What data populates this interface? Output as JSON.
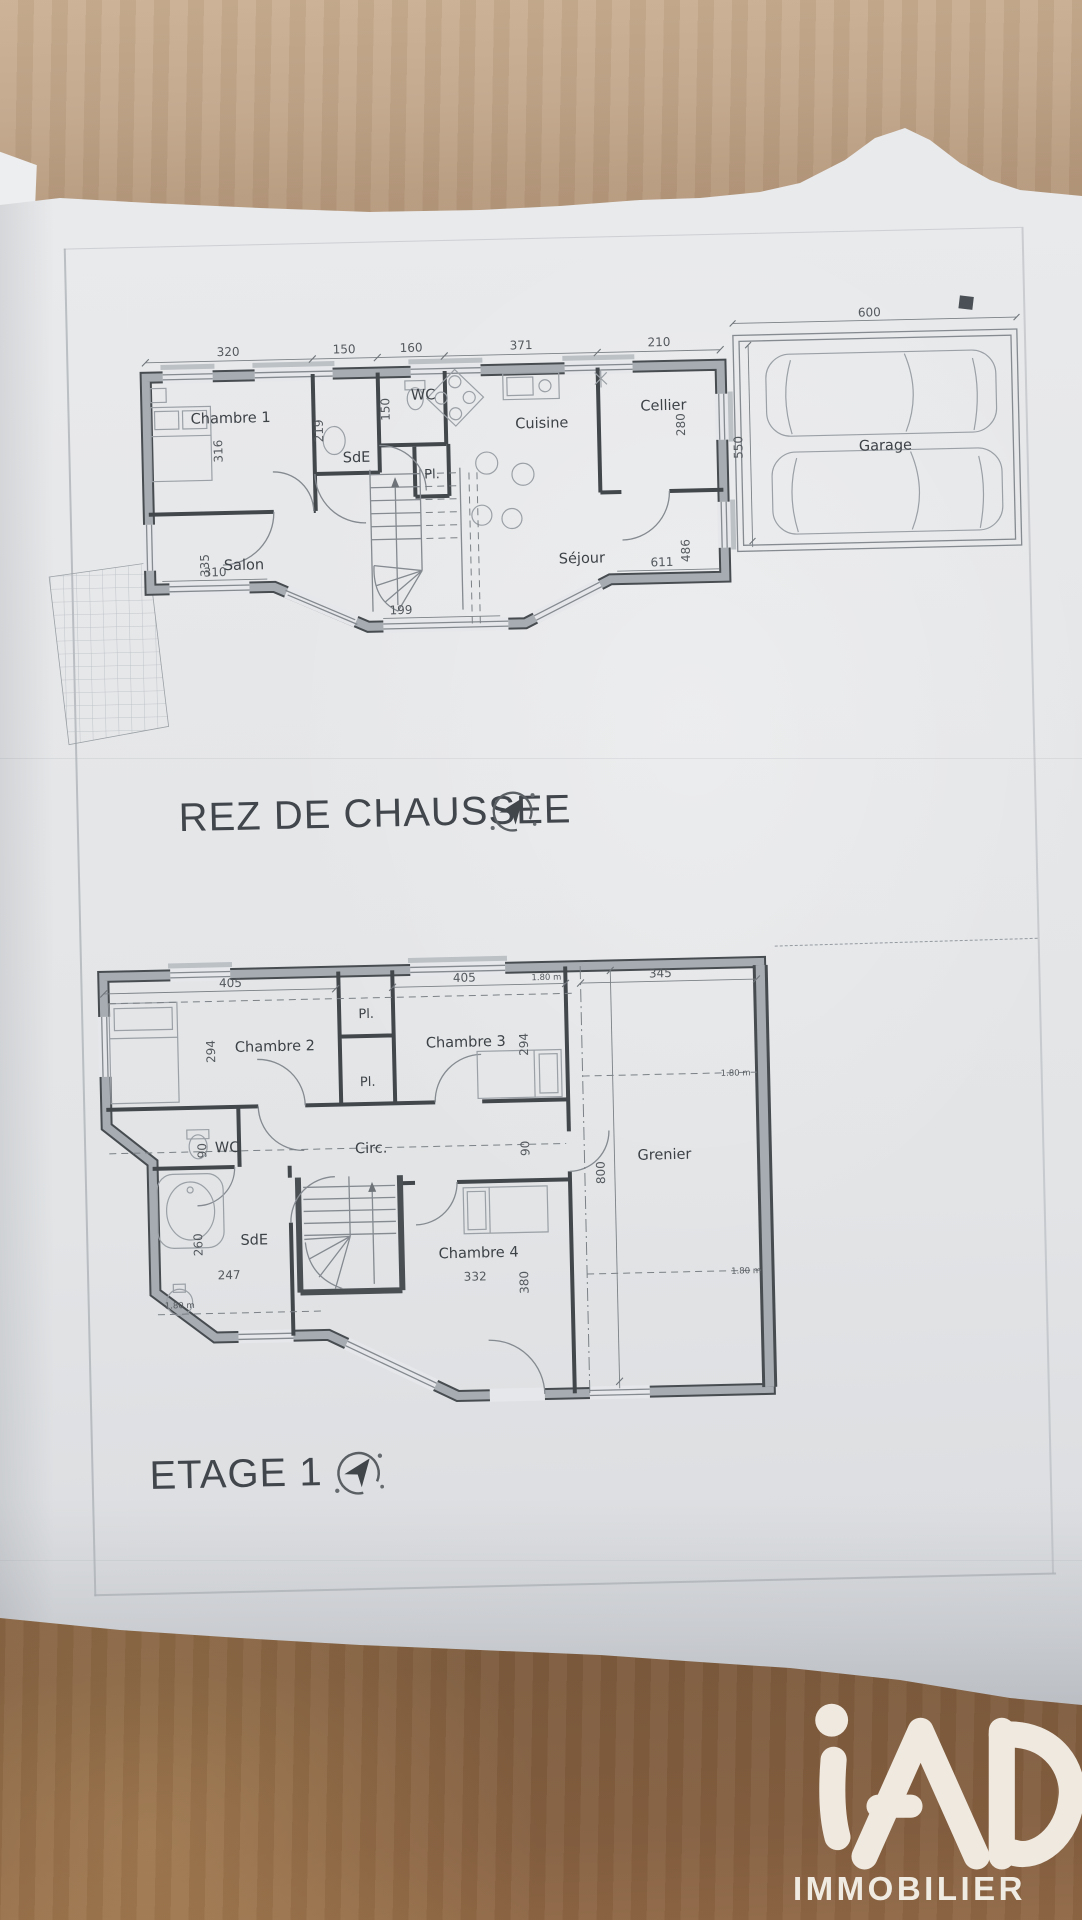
{
  "titles": {
    "ground": "REZ DE CHAUSSEE",
    "floor1": "ETAGE 1"
  },
  "ground": {
    "rooms": {
      "chambre1": "Chambre 1",
      "sde": "SdE",
      "wc": "WC",
      "pl": "Pl.",
      "cuisine": "Cuisine",
      "cellier": "Cellier",
      "garage": "Garage",
      "salon": "Salon",
      "sejour": "Séjour"
    },
    "dims": {
      "chambre1_w": "320",
      "sde_w": "150",
      "wc_w": "160",
      "cuisine_w": "371",
      "cellier_w": "210",
      "garage_w": "600",
      "garage_h": "550",
      "chambre1_h": "316",
      "sde_h": "219",
      "wc_h": "150",
      "cellier_h": "280",
      "salon_h": "335",
      "salon_w": "310",
      "stair_w": "199",
      "sejour_w": "611",
      "sejour_h": "486"
    }
  },
  "floor1": {
    "rooms": {
      "chambre2": "Chambre 2",
      "chambre3": "Chambre 3",
      "grenier": "Grenier",
      "wc": "WC",
      "circ": "Circ.",
      "sde": "SdE",
      "chambre4": "Chambre 4",
      "pl_top": "Pl.",
      "pl_mid": "Pl."
    },
    "dims": {
      "chambre2_w": "405",
      "chambre3_w": "405",
      "grenier_w": "345",
      "chambre2_h": "294",
      "chambre3_h": "294",
      "grenier_h": "800",
      "wc_h": "90",
      "circ_h": "90",
      "sde_h": "260",
      "sde_w": "247",
      "chambre4_w": "332",
      "chambre4_h": "380"
    },
    "height_markers": {
      "m1": "1.80 m",
      "m2": "1.80 m",
      "m3": "1.80 m",
      "m4": "1.80 m"
    }
  },
  "watermark": {
    "brand_i": "i",
    "subtitle": "IMMOBILIER"
  }
}
